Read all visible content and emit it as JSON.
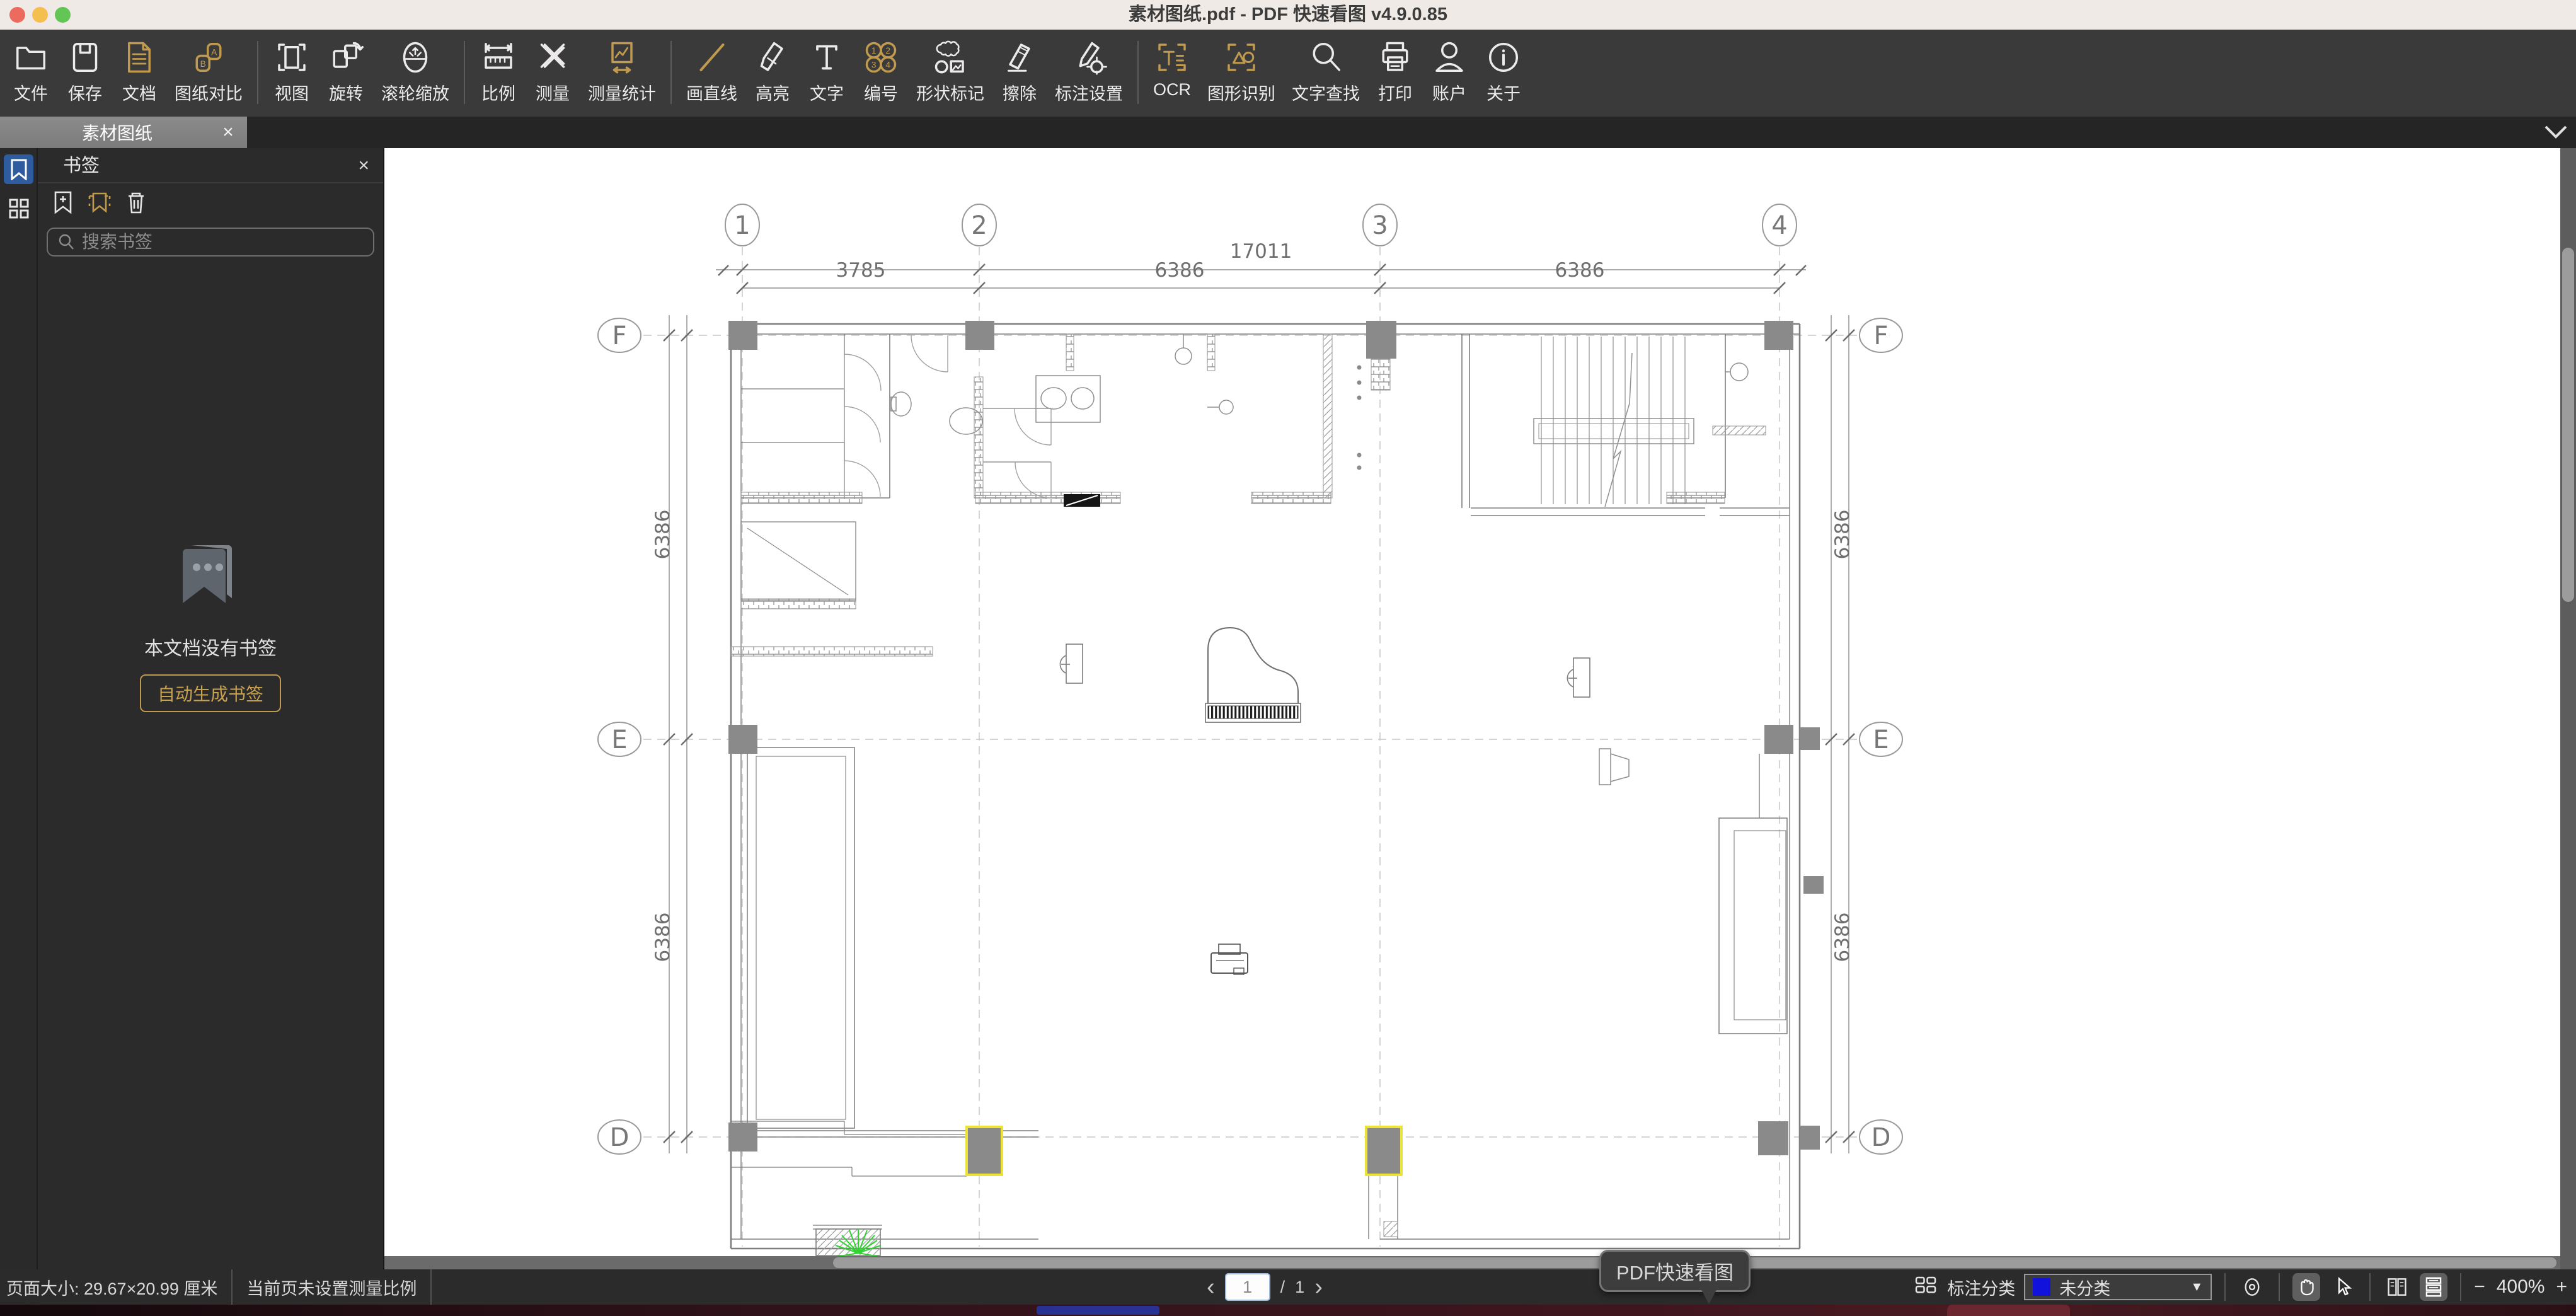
{
  "window": {
    "title": "素材图纸.pdf - PDF 快速看图 v4.9.0.85"
  },
  "toolbar": {
    "items": [
      {
        "label": "文件",
        "icon": "folder",
        "tone": "white"
      },
      {
        "label": "保存",
        "icon": "save",
        "tone": "white"
      },
      {
        "label": "文档",
        "icon": "document",
        "tone": "gold"
      },
      {
        "label": "图纸对比",
        "icon": "compare",
        "tone": "gold"
      },
      {
        "divider": true
      },
      {
        "label": "视图",
        "icon": "view",
        "tone": "white"
      },
      {
        "label": "旋转",
        "icon": "rotate",
        "tone": "white"
      },
      {
        "label": "滚轮缩放",
        "icon": "wheel-zoom",
        "tone": "white"
      },
      {
        "divider": true
      },
      {
        "label": "比例",
        "icon": "scale-ruler",
        "tone": "white"
      },
      {
        "label": "测量",
        "icon": "measure",
        "tone": "white"
      },
      {
        "label": "测量统计",
        "icon": "measure-stats",
        "tone": "gold"
      },
      {
        "divider": true
      },
      {
        "label": "画直线",
        "icon": "draw-line",
        "tone": "gold"
      },
      {
        "label": "高亮",
        "icon": "highlight",
        "tone": "white"
      },
      {
        "label": "文字",
        "icon": "text",
        "tone": "white"
      },
      {
        "label": "编号",
        "icon": "numbering",
        "tone": "gold"
      },
      {
        "label": "形状标记",
        "icon": "shape-mark",
        "tone": "white"
      },
      {
        "label": "擦除",
        "icon": "erase",
        "tone": "white"
      },
      {
        "label": "标注设置",
        "icon": "annot-settings",
        "tone": "white"
      },
      {
        "divider": true
      },
      {
        "label": "OCR",
        "icon": "ocr",
        "tone": "gold"
      },
      {
        "label": "图形识别",
        "icon": "shape-recognize",
        "tone": "gold"
      },
      {
        "label": "文字查找",
        "icon": "text-search",
        "tone": "white"
      },
      {
        "label": "打印",
        "icon": "print",
        "tone": "white"
      },
      {
        "label": "账户",
        "icon": "account",
        "tone": "white"
      },
      {
        "label": "关于",
        "icon": "about",
        "tone": "white"
      }
    ]
  },
  "tabbar": {
    "active_tab": "素材图纸",
    "close": "×"
  },
  "sidebar": {
    "panel_title": "书签",
    "close": "×",
    "search_placeholder": "搜索书签",
    "empty_text": "本文档没有书签",
    "auto_generate_label": "自动生成书签"
  },
  "drawing": {
    "grid_cols": [
      "1",
      "2",
      "3",
      "4"
    ],
    "grid_rows": [
      "F",
      "E",
      "D"
    ],
    "dims_top": {
      "overall": "17011",
      "segments": [
        "3785",
        "6386",
        "6386"
      ]
    },
    "dims_left": [
      "6386",
      "6386"
    ],
    "dims_right": [
      "6386",
      "6386"
    ]
  },
  "pager": {
    "prev": "‹",
    "current": "1",
    "separator": "/",
    "total": "1",
    "next": "›"
  },
  "tooltip": {
    "text": "PDF快速看图"
  },
  "statusbar": {
    "page_size": "页面大小: 29.67×20.99 厘米",
    "measure_hint": "当前页未设置测量比例",
    "annotation_category_label": "标注分类",
    "annotation_category_value": "未分类",
    "zoom_out": "−",
    "zoom_level": "400%",
    "zoom_in": "+"
  },
  "colors": {
    "accent_gold": "#c09a4e",
    "rail_active_blue": "#2e5c9e",
    "column_highlight_yellow": "#ece23a",
    "category_swatch_blue": "#1212dd"
  }
}
